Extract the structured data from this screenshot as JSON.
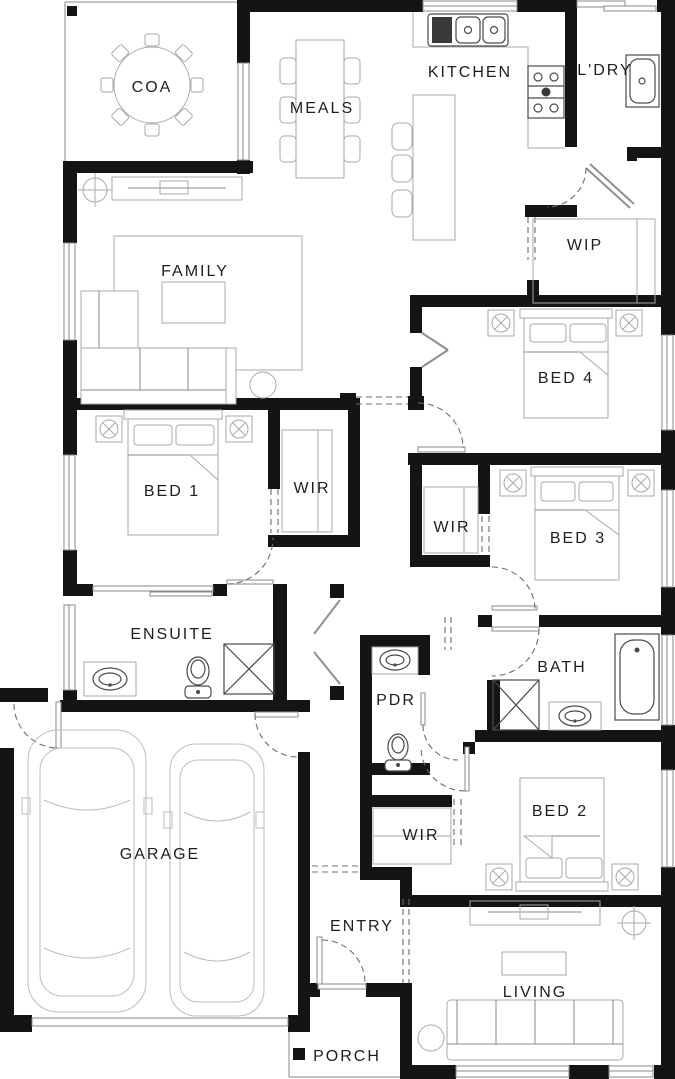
{
  "meta": {
    "type": "architectural-floor-plan",
    "background_color": "#ffffff",
    "wall_color": "#141414",
    "furniture_color": "#a9a9a9",
    "fixture_color": "#4a4a4a"
  },
  "rooms": {
    "coa": {
      "label": "COA"
    },
    "meals": {
      "label": "MEALS"
    },
    "kitchen": {
      "label": "KITCHEN"
    },
    "laundry": {
      "label": "L'DRY"
    },
    "wip": {
      "label": "WIP"
    },
    "family": {
      "label": "FAMILY"
    },
    "bed4": {
      "label": "BED 4"
    },
    "bed1": {
      "label": "BED 1"
    },
    "wir_bed1": {
      "label": "WIR"
    },
    "wir_bed3": {
      "label": "WIR"
    },
    "bed3": {
      "label": "BED 3"
    },
    "ensuite": {
      "label": "ENSUITE"
    },
    "pdr": {
      "label": "PDR"
    },
    "bath": {
      "label": "BATH"
    },
    "wir_bed2": {
      "label": "WIR"
    },
    "bed2": {
      "label": "BED 2"
    },
    "garage": {
      "label": "GARAGE"
    },
    "entry": {
      "label": "ENTRY"
    },
    "living": {
      "label": "LIVING"
    },
    "porch": {
      "label": "PORCH"
    }
  },
  "fixtures": {
    "coa": [
      "round-dining-table",
      "dining-chairs-x8",
      "post"
    ],
    "meals": [
      "dining-table",
      "dining-chairs-x6"
    ],
    "kitchen": [
      "double-bowl-sink",
      "drainer",
      "cooktop",
      "island-bench",
      "bar-stools-x3",
      "counter",
      "window"
    ],
    "laundry": [
      "laundry-trough",
      "sliding-door"
    ],
    "wip": [
      "pantry-shelving",
      "cavity-door"
    ],
    "family": [
      "tv-unit",
      "tv",
      "ceiling-fan",
      "rug",
      "corner-sofa",
      "coffee-table",
      "side-table",
      "window"
    ],
    "bed1": [
      "double-bed",
      "bedside-tables-x2",
      "window"
    ],
    "bed2": [
      "double-bed",
      "bedside-tables-x2",
      "window"
    ],
    "bed3": [
      "double-bed",
      "bedside-tables-x2",
      "window"
    ],
    "bed4": [
      "double-bed",
      "bedside-tables-x2",
      "built-in-robe",
      "window"
    ],
    "wir_bed1": [
      "wardrobe-shelving"
    ],
    "wir_bed2": [
      "wardrobe-shelving"
    ],
    "wir_bed3": [
      "wardrobe-shelving"
    ],
    "ensuite": [
      "vanity-basin",
      "toilet",
      "shower",
      "cavity-sliding-door",
      "window"
    ],
    "pdr": [
      "vanity-basin",
      "toilet",
      "door"
    ],
    "bath": [
      "shower",
      "vanity-basin",
      "bathtub",
      "window"
    ],
    "linen": [
      "bifold-doors"
    ],
    "garage": [
      "cars-x2",
      "panel-lift-door",
      "side-door",
      "internal-access-door"
    ],
    "entry": [
      "front-door"
    ],
    "living": [
      "tv-unit",
      "tv",
      "ceiling-fan",
      "coffee-table",
      "sofa",
      "side-table",
      "windows"
    ],
    "porch": [
      "post"
    ]
  }
}
